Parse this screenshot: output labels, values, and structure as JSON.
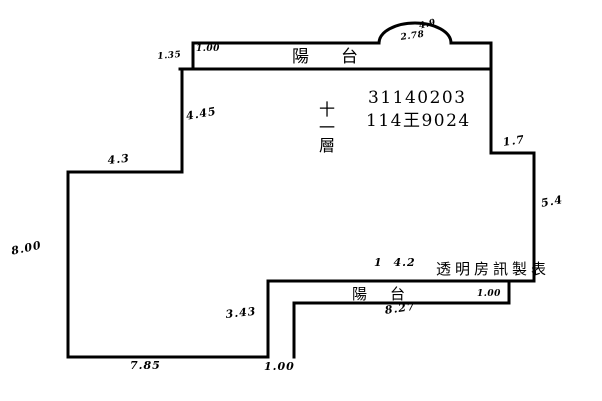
{
  "colors": {
    "background": "#ffffff",
    "line": "#000000"
  },
  "plan": {
    "top_balcony": {
      "name": "陽台",
      "dim_inner_left": "1.00",
      "dim_outer_left": "1.35",
      "arch": {
        "dim_top": "4.9",
        "dim_width": "2.78"
      }
    },
    "unit": {
      "floor": "十一層",
      "case_number": "31140203",
      "building_number": "114王9024",
      "dim_left_upper_wall": "4.45",
      "dim_top_left_wall": "4.3",
      "dim_left_wall": "8.00",
      "dim_right_step": "1.7",
      "dim_right_wall": "5.4",
      "dim_bottom_inner": "1 4.2",
      "dim_left_step": "3.43",
      "dim_bottom_wall": "7.85",
      "dim_bottom_step": "1.00"
    },
    "bottom_balcony": {
      "name": "陽台",
      "dim_inner_right": "1.00",
      "dim_width": "8.27"
    },
    "credit": "透明房訊製表"
  }
}
